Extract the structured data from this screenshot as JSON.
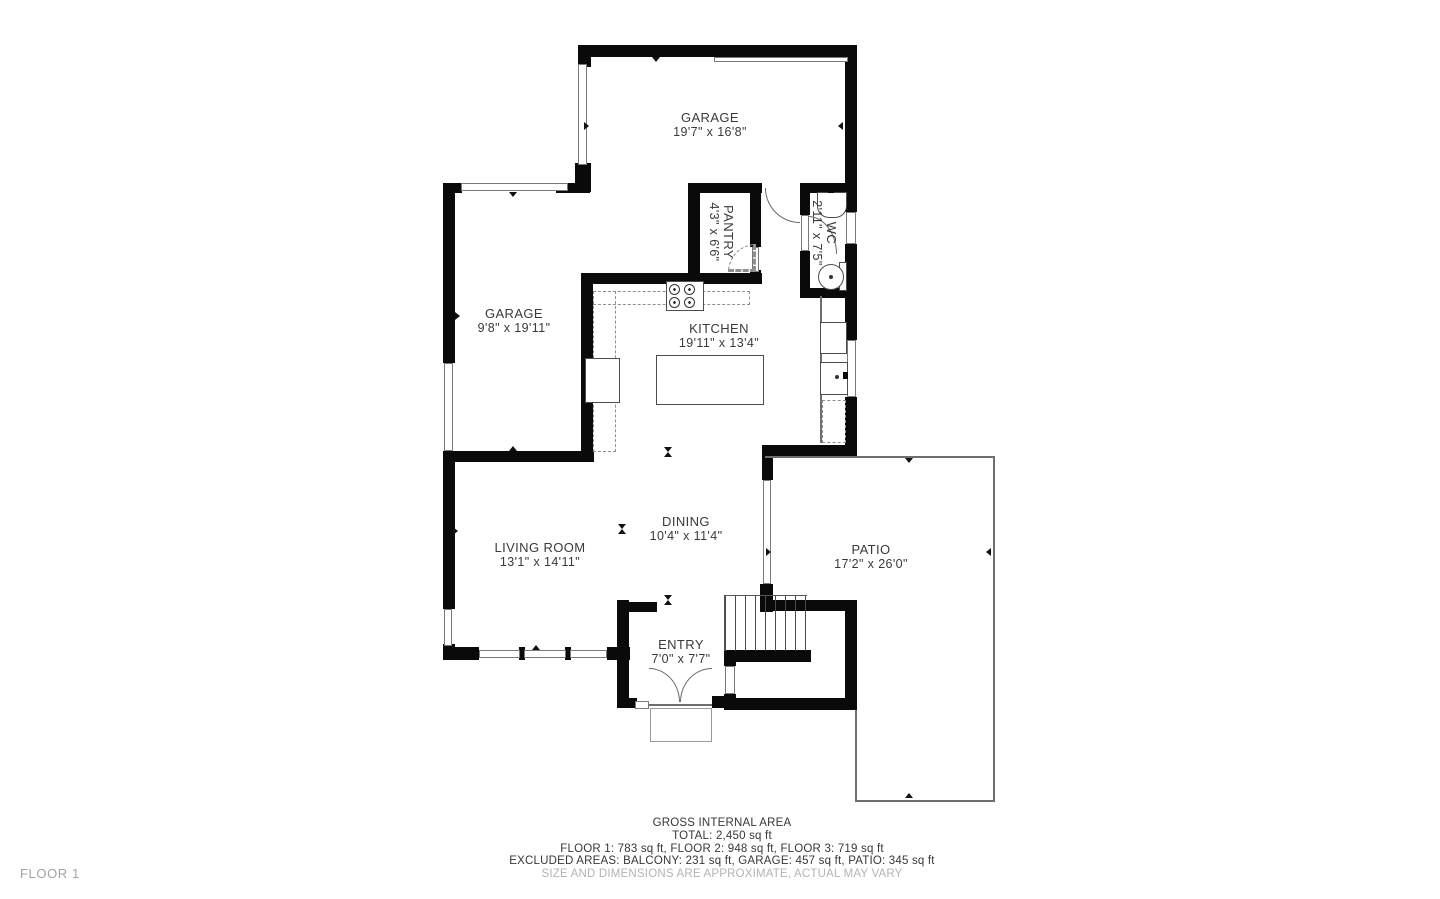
{
  "floor_label": "FLOOR 1",
  "rooms": [
    {
      "id": "garage-main",
      "name": "GARAGE",
      "dims": "19'7\" x 16'8\""
    },
    {
      "id": "garage-second",
      "name": "GARAGE",
      "dims": "9'8\" x 19'11\""
    },
    {
      "id": "pantry",
      "name": "PANTRY",
      "dims": "4'3\" x 6'6\""
    },
    {
      "id": "wc",
      "name": "WC",
      "dims": "2'11\" x 7'5\""
    },
    {
      "id": "kitchen",
      "name": "KITCHEN",
      "dims": "19'11\" x 13'4\""
    },
    {
      "id": "dining",
      "name": "DINING",
      "dims": "10'4\" x 11'4\""
    },
    {
      "id": "living-room",
      "name": "LIVING ROOM",
      "dims": "13'1\" x 14'11\""
    },
    {
      "id": "entry",
      "name": "ENTRY",
      "dims": "7'0\" x 7'7\""
    },
    {
      "id": "patio",
      "name": "PATIO",
      "dims": "17'2\" x 26'0\""
    }
  ],
  "summary": {
    "title": "GROSS INTERNAL AREA",
    "total": "TOTAL: 2,450 sq ft",
    "floors": "FLOOR 1: 783 sq ft, FLOOR 2: 948 sq ft, FLOOR 3: 719 sq ft",
    "excluded": "EXCLUDED AREAS: BALCONY: 231 sq ft, GARAGE: 457 sq ft, PATIO: 345 sq ft",
    "disclaimer": "SIZE AND DIMENSIONS ARE APPROXIMATE, ACTUAL MAY VARY"
  },
  "colors": {
    "wall": "#0a0a0a",
    "thin_line": "#6e6e6e",
    "label_text": "#3a3a3a",
    "muted_text": "#b4b4b4"
  }
}
